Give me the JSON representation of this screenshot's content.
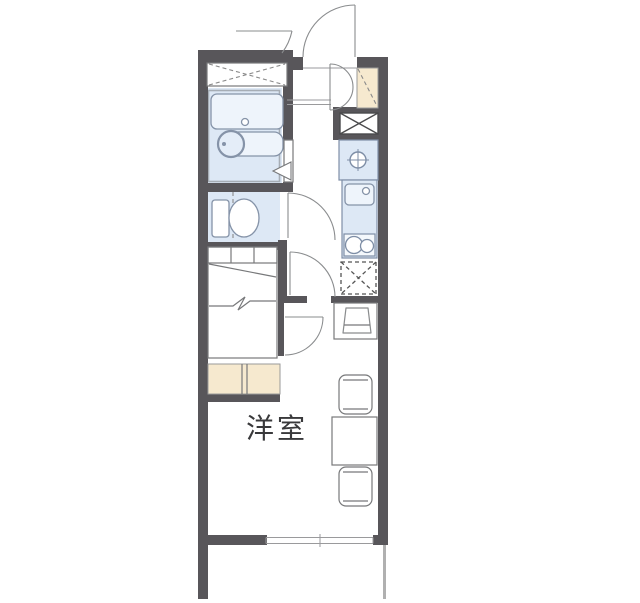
{
  "plan": {
    "room_label": "洋室",
    "room_label_meaning": "Western-style room",
    "colors": {
      "wall": "#58565a",
      "wet_area_fill": "#dde8f5",
      "fixture_fill": "#eef4fb",
      "cabinet_fill": "#f6e9cf",
      "thin_line": "#77787a",
      "background": "#ffffff"
    },
    "fixtures": [
      "bathtub",
      "washbasin",
      "shower-room",
      "toilet",
      "bed",
      "under-bed-shelf",
      "kitchen-sink",
      "two-burner-stove",
      "refrigerator-space",
      "washing-machine-pan",
      "shoe-cabinet",
      "tall-storage-cabinet",
      "pipe-space",
      "upper-storage-shelf",
      "desk-with-chair",
      "dining-table",
      "chair",
      "chair",
      "entrance-door",
      "exterior-compartment-door",
      "toilet-door",
      "room-door",
      "bed-nook-door",
      "folding-bath-door",
      "sliding-window",
      "balcony"
    ]
  }
}
